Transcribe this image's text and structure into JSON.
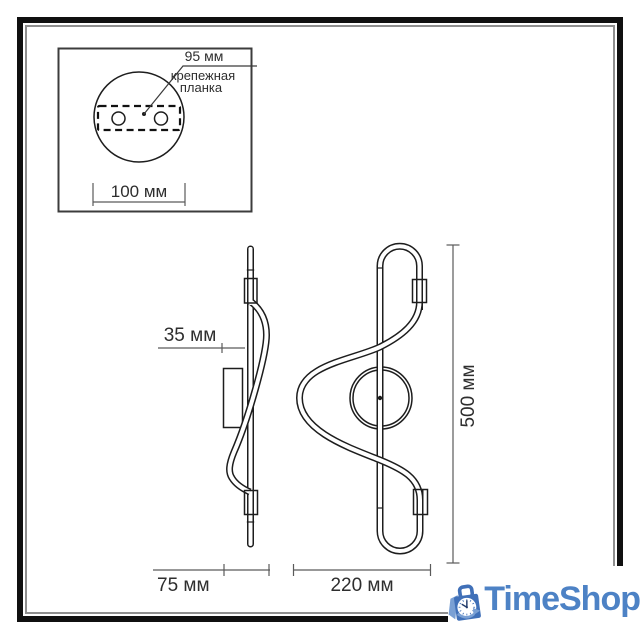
{
  "drawing": {
    "line_color": "#1d1d1d",
    "detail_inset": {
      "hole_spacing_label": "95 мм",
      "part_name_line1": "крепежная",
      "part_name_line2": "планка",
      "base_width_label": "100 мм"
    },
    "side_view": {
      "tube_offset_label": "35 мм",
      "depth_label": "75 мм"
    },
    "front_view": {
      "width_label": "220 мм",
      "height_label": "500 мм"
    }
  },
  "watermark": {
    "brand": "TimeShop",
    "icon": "clock-shopping-bag-icon",
    "text_color": "#4d82c5",
    "bag_color": "#4070b8",
    "accent_color": "#7aa0d4",
    "hands_color": "#223c6b"
  }
}
